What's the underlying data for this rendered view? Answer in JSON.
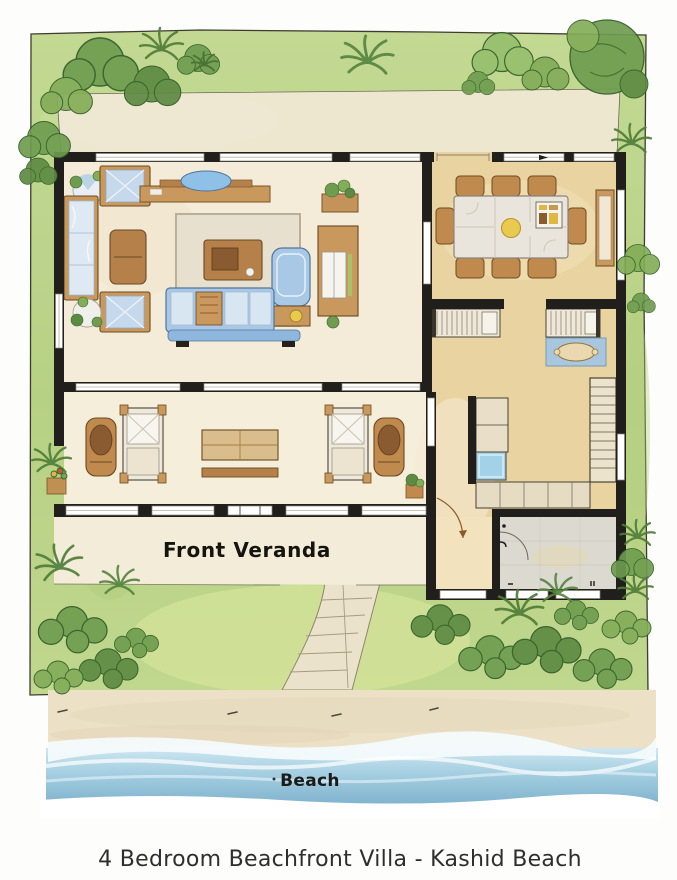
{
  "artwork": {
    "type": "watercolor-floor-plan-illustration",
    "caption": "4 Bedroom Beachfront Villa - Kashid Beach"
  },
  "labels": {
    "front_veranda": "Front Veranda",
    "beach": "Beach"
  },
  "elements": [
    "grass-lawn",
    "tree-canopy",
    "palm-plant",
    "bush",
    "back-patio-strip",
    "living-room",
    "sofa",
    "chaise-lounge",
    "coffee-table",
    "area-rug",
    "armchair",
    "console-table",
    "media-cabinet",
    "potted-plant",
    "dining-room",
    "dining-table",
    "dining-chair",
    "sideboard",
    "kitchen-counter",
    "kitchen-sink",
    "staircase",
    "blue-bath-mat",
    "front-veranda",
    "daybed",
    "veranda-bench",
    "lounge-chair",
    "entry-porch",
    "hallway",
    "door-swing",
    "window",
    "wall",
    "stone-path",
    "beach-sand",
    "sea-waves",
    "foam"
  ],
  "colors": {
    "grass": "#b9d287",
    "grass_light": "#d9e8a6",
    "foliage_dark": "#4f7d38",
    "foliage_mid": "#6f9c4f",
    "foliage_light": "#8db763",
    "wall": "#211f1b",
    "floor_cream": "#f4ecd8",
    "floor_tan": "#e9d3a1",
    "floor_gray": "#dcd9d1",
    "wood": "#c9985c",
    "wood_dark": "#b5804a",
    "sofa_blue": "#a9c8e6",
    "cushion_light": "#d8e6f2",
    "sink_blue": "#a3d2e8",
    "sand": "#ece0c6",
    "sea": "#8fc3da",
    "sea_light": "#d3e9f2",
    "stone": "#ebe2cc",
    "accent_yellow": "#e9c94e",
    "ink": "#2b2b2b"
  }
}
